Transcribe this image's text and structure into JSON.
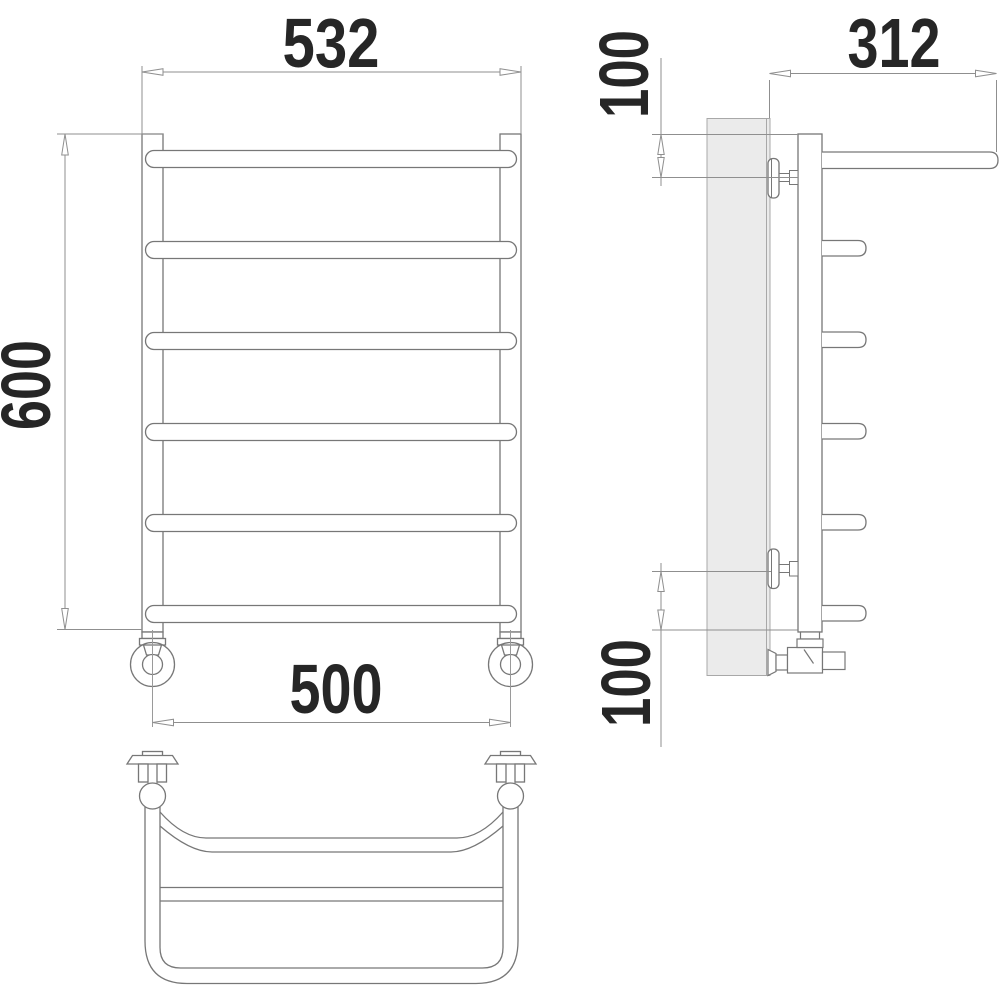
{
  "drawing": {
    "title": "ladder-towel-rail-technical-drawing",
    "units": "mm",
    "dimensions": {
      "front_width": "532",
      "front_height": "600",
      "connection_spacing": "500",
      "side_depth": "312",
      "top_offset": "100",
      "bottom_offset": "100"
    },
    "views": {
      "front": {
        "name": "front-view",
        "rung_count": 6,
        "collector_count": 2,
        "wall_flange_count": 2
      },
      "side": {
        "name": "side-view",
        "rung_stub_count": 5,
        "bracket_count": 2,
        "valve_count": 1
      },
      "top": {
        "name": "top-view",
        "wall_mount_count": 2,
        "bowed_rail": 1,
        "straight_rail": 1
      }
    },
    "colors": {
      "line": "#777777",
      "dim_line": "#8f8f8f",
      "text": "#262626",
      "wall_fill": "#ebebeb",
      "wall_stroke": "#a8a8a8",
      "background": "#ffffff"
    }
  }
}
